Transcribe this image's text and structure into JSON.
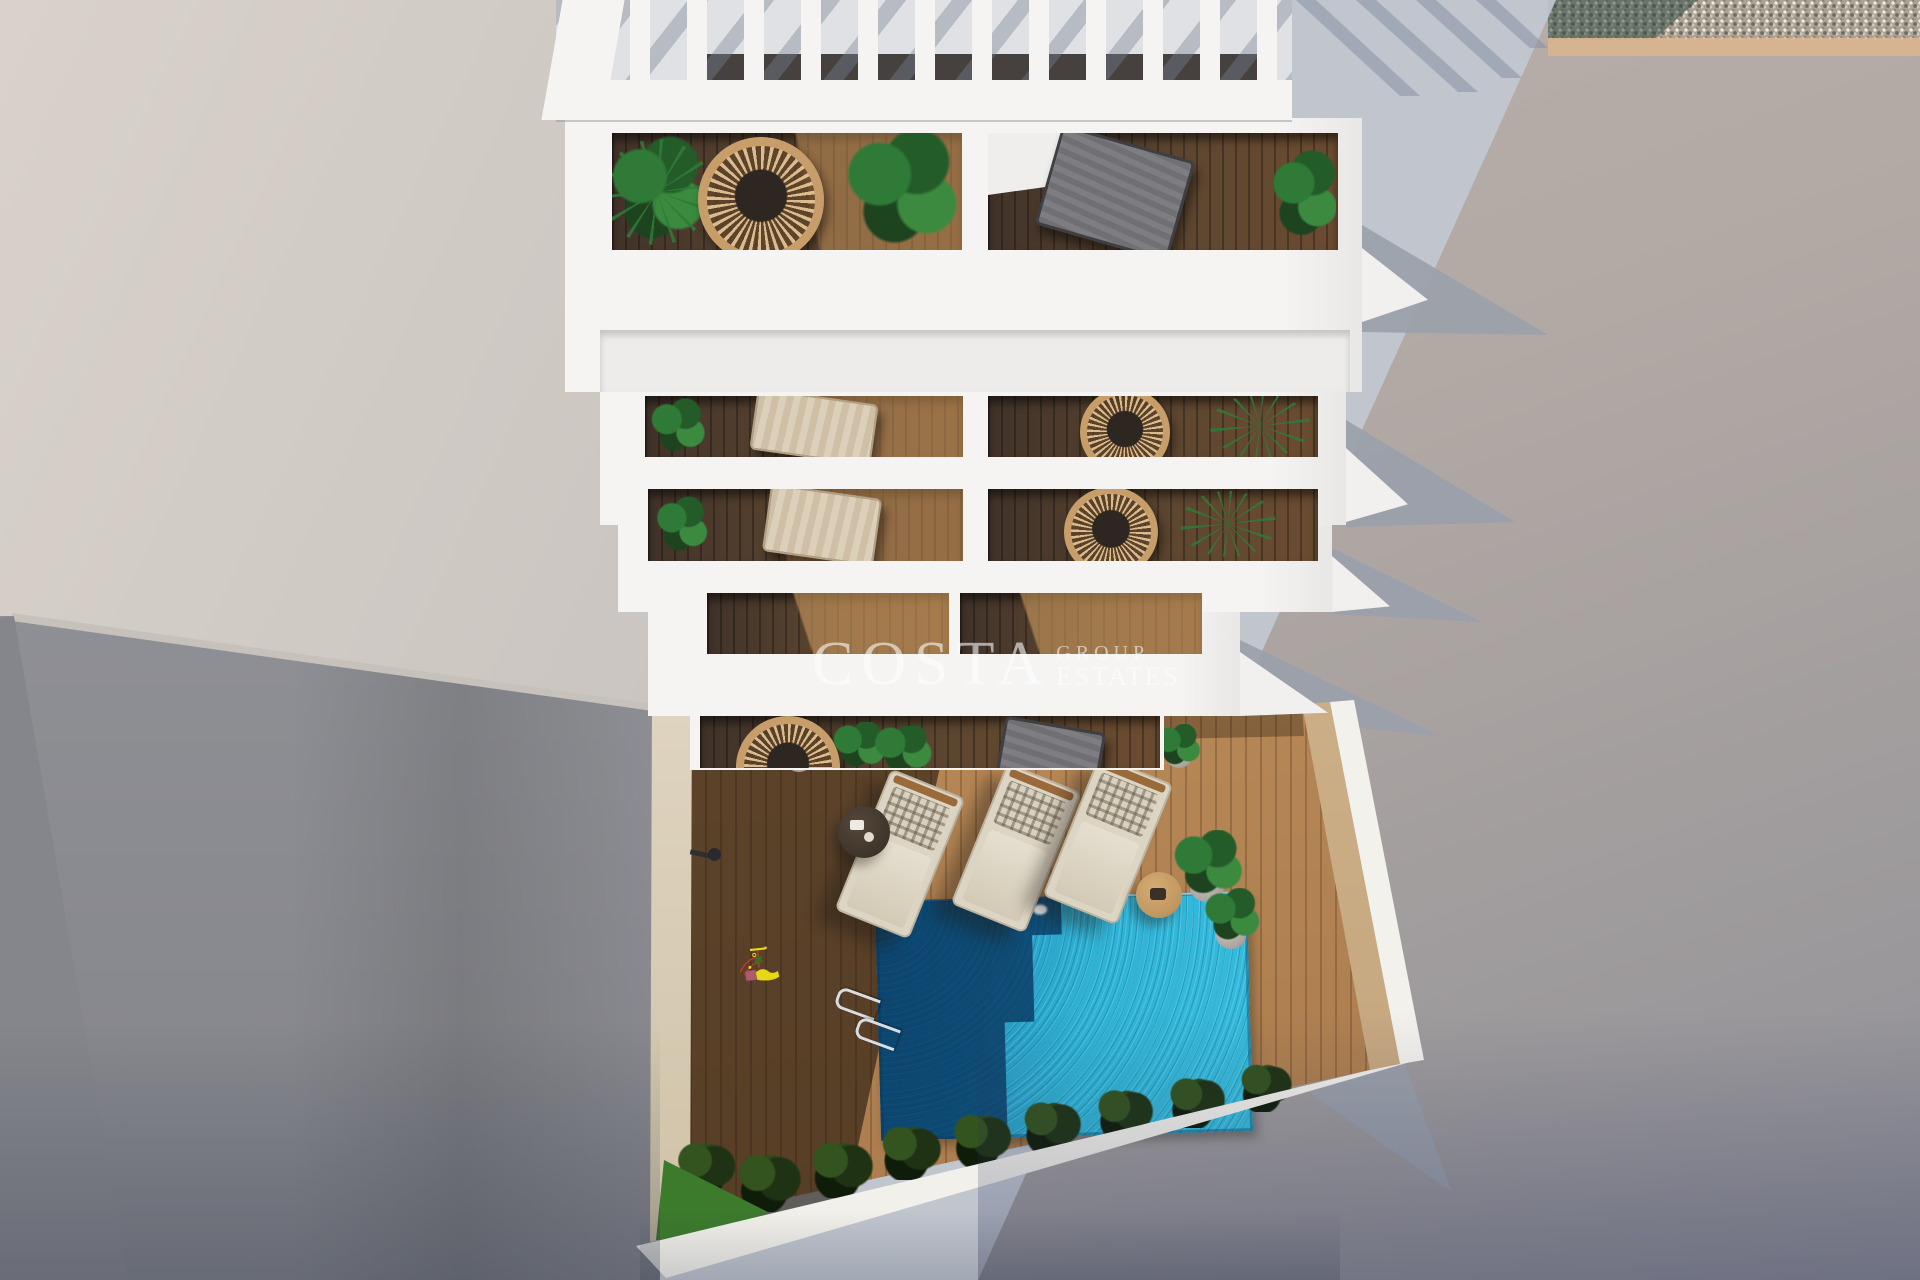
{
  "watermark": {
    "brand": "COSTA",
    "sub1": "GROUP",
    "sub2": "ESTATES"
  },
  "scene": {
    "kind": "aerial 3D render of white apartment building with balconies and pool courtyard",
    "sun_lounger_count": 3,
    "balcony_row_count": 5
  },
  "palette": {
    "ground-light": "#d8d2ca",
    "ground-base": "#c8c3bf",
    "ground-sunlit": "#b2a9a4",
    "shadow-cool": "#bfc5cf",
    "shadow-deep": "#9aa0ab",
    "wall-gray": "#97979b",
    "wall-gray-dark": "#7f8085",
    "building-white": "#f5f4f2",
    "building-shade": "#e8e7e5",
    "pergola-floor": "#dfe1e4",
    "window-dark": "#35302b",
    "wood-dark": "#41332a",
    "wood-mid": "#5d4630",
    "wood-sun": "#8a6038",
    "deck-light": "#bb8c5a",
    "plant-green": "#2f7a37",
    "plant-deep": "#1d431f",
    "wicker-tan": "#c0965f",
    "cushion-beige": "#ddd5c4",
    "chair-gray": "#707074",
    "pool-bright": "#2db3d6",
    "pool-mid": "#1a7fae",
    "pool-dark": "#0d4a7d",
    "slide-yellow": "#e8d714",
    "frame-red": "#c53a28",
    "seat-pink": "#ae5a6e",
    "grass-green": "#3c7a2c",
    "bush-dark": "#1a2a12",
    "gravel-base": "#aaa295",
    "sand-border": "#d9b48f",
    "watermark-white": "rgba(255,255,255,0.58)"
  }
}
